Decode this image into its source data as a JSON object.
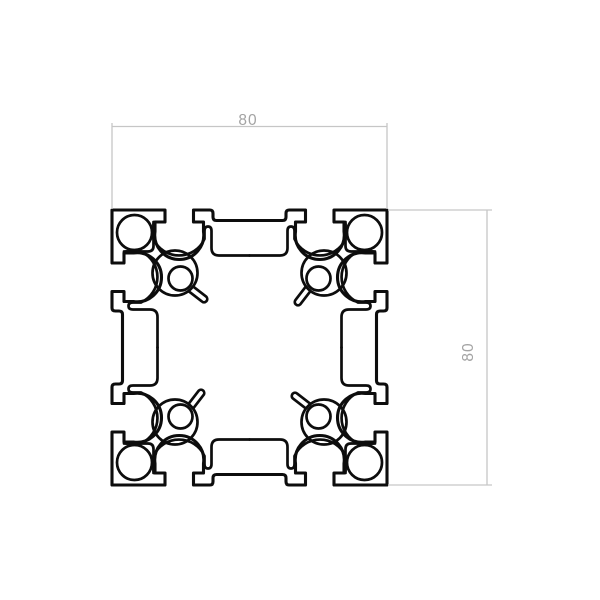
{
  "title": "aluminum-profile-8080-cross-section",
  "dimensions": {
    "top": {
      "label": "80"
    },
    "right": {
      "label": "80"
    }
  },
  "colors": {
    "background": "#ffffff",
    "outline": "#0d0d0d",
    "dim_line": "#c6c6c6",
    "dim_text": "#a3a3a3"
  },
  "strokes": {
    "outer": 3.1,
    "inner": 2.7,
    "dim": 1.3
  },
  "dim_text_font_size": 15.5,
  "geometry": {
    "bounds": {
      "left": 112,
      "top": 210,
      "size": 275
    },
    "outer_side": [
      [
        "L",
        165,
        210
      ],
      [
        "L",
        165,
        222
      ],
      [
        "L",
        155,
        222
      ],
      [
        "L",
        155,
        231.5
      ],
      [
        "A",
        24.5,
        1,
        0,
        203.5,
        231.5
      ],
      [
        "L",
        203.5,
        222
      ],
      [
        "L",
        193.5,
        222
      ],
      [
        "L",
        193.5,
        210
      ],
      [
        "L",
        210,
        210
      ],
      [
        "Q",
        213,
        210,
        213,
        213.5
      ],
      [
        "L",
        213,
        217
      ],
      [
        "Q",
        213,
        220.5,
        216.5,
        220.5
      ],
      [
        "L",
        282.5,
        220.5
      ],
      [
        "Q",
        286,
        220.5,
        286,
        217
      ],
      [
        "L",
        286,
        213.5
      ],
      [
        "Q",
        286,
        210,
        289,
        210
      ],
      [
        "L",
        305.5,
        210
      ],
      [
        "L",
        305.5,
        222
      ],
      [
        "L",
        295.5,
        222
      ],
      [
        "L",
        295.5,
        231.5
      ],
      [
        "A",
        24.5,
        1,
        0,
        344,
        231.5
      ],
      [
        "L",
        344,
        222
      ],
      [
        "L",
        334,
        222
      ],
      [
        "L",
        334,
        210
      ],
      [
        "L",
        387,
        210
      ]
    ],
    "cavity_piece": [
      [
        "M",
        249.5,
        255.5
      ],
      [
        "L",
        219,
        255.5
      ],
      [
        "Q",
        211.5,
        255.5,
        211.5,
        248
      ],
      [
        "L",
        211.5,
        231
      ],
      [
        "Q",
        211.5,
        226.5,
        208,
        226.5
      ],
      [
        "Q",
        204.5,
        226.5,
        204.5,
        231
      ],
      [
        "L",
        204.5,
        239
      ],
      [
        "A",
        28,
        0,
        1,
        153.5,
        239
      ],
      [
        "L",
        153.5,
        224
      ]
    ],
    "block_piece": [
      [
        "M",
        124,
        251.5
      ],
      [
        "L",
        148,
        251.5
      ],
      [
        "Q",
        153.5,
        251.5,
        153.5,
        246
      ],
      [
        "L",
        153.5,
        222
      ]
    ],
    "spur_piece": [
      [
        "M",
        193.2,
        286.6
      ],
      [
        "L",
        206.3,
        296.7
      ],
      [
        "A",
        3.2,
        0,
        1,
        201.7,
        301.3
      ],
      [
        "L",
        188.6,
        291.2
      ]
    ],
    "circles": {
      "big": {
        "cx": 134.5,
        "cy": 232.5,
        "r": 17.5
      },
      "small": {
        "cx": 180.5,
        "cy": 278.5,
        "r": 12
      },
      "boss": {
        "cx": 175,
        "cy": 273,
        "r": 22.5
      }
    },
    "dim_top": {
      "line": [
        112,
        126.5,
        387,
        126.5
      ],
      "ext": [
        [
          112,
          123,
          112,
          209
        ],
        [
          387,
          123,
          387,
          209
        ]
      ],
      "text_pos": [
        248,
        125
      ],
      "rotate": 0
    },
    "dim_right": {
      "line": [
        487,
        210,
        487,
        485
      ],
      "ext": [
        [
          388,
          210,
          492,
          210
        ],
        [
          388,
          485,
          492,
          485
        ]
      ],
      "text_pos": [
        473,
        352
      ],
      "rotate": -90
    }
  }
}
